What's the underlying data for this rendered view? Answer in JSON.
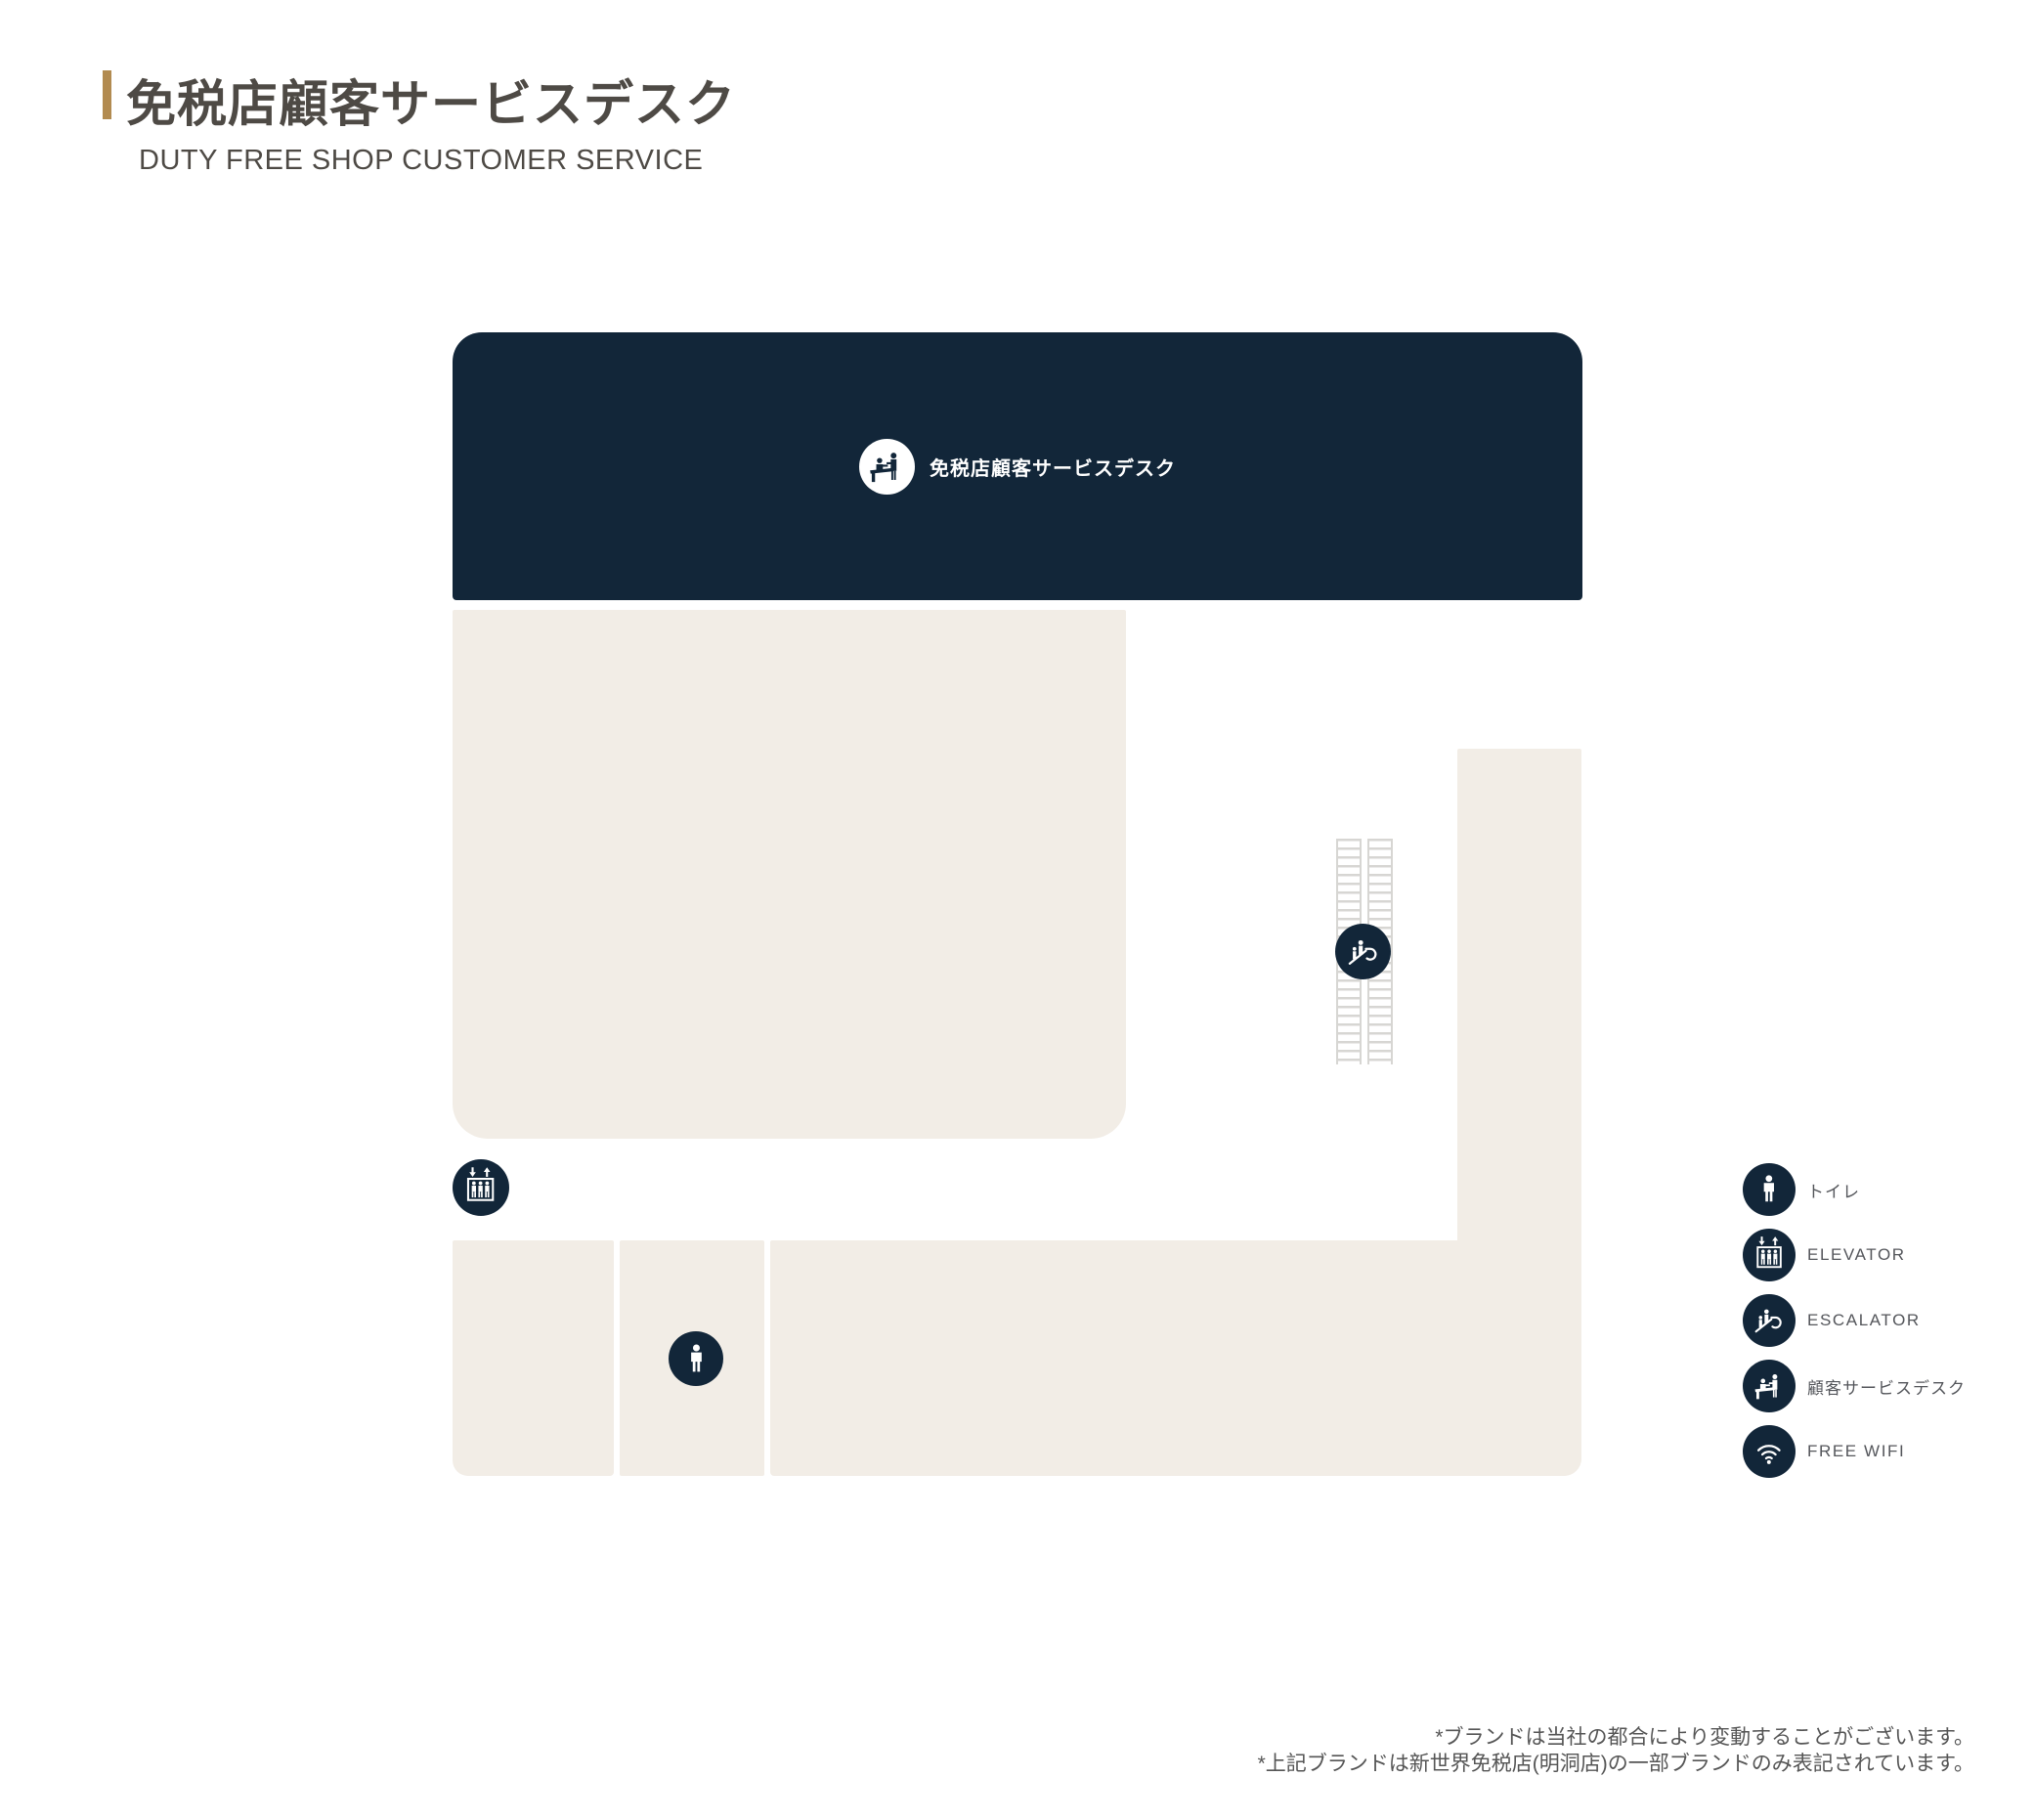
{
  "header": {
    "title": "免税店顧客サービスデスク",
    "subtitle": "DUTY FREE SHOP CUSTOMER SERVICE"
  },
  "map": {
    "banner": {
      "icon": "service-desk-icon",
      "label": "免税店顧客サービスデスク"
    },
    "markers": [
      {
        "id": "elevator",
        "icon": "elevator-icon"
      },
      {
        "id": "escalator",
        "icon": "escalator-icon"
      },
      {
        "id": "toilet",
        "icon": "toilet-icon"
      }
    ]
  },
  "legend": {
    "items": [
      {
        "icon": "toilet-icon",
        "label": "トイレ"
      },
      {
        "icon": "elevator-icon",
        "label": "ELEVATOR"
      },
      {
        "icon": "escalator-icon",
        "label": "ESCALATOR"
      },
      {
        "icon": "service-desk-icon",
        "label": "顧客サービスデスク"
      },
      {
        "icon": "wifi-icon",
        "label": "FREE WIFI"
      }
    ]
  },
  "footnotes": [
    "*ブランドは当社の都合により変動することがございます。",
    "*上記ブランドは新世界免税店(明洞店)の一部ブランドのみ表記されています。"
  ],
  "colors": {
    "navy": "#122639",
    "beige": "#F2EDE6",
    "accent_gold": "#B28B50"
  }
}
